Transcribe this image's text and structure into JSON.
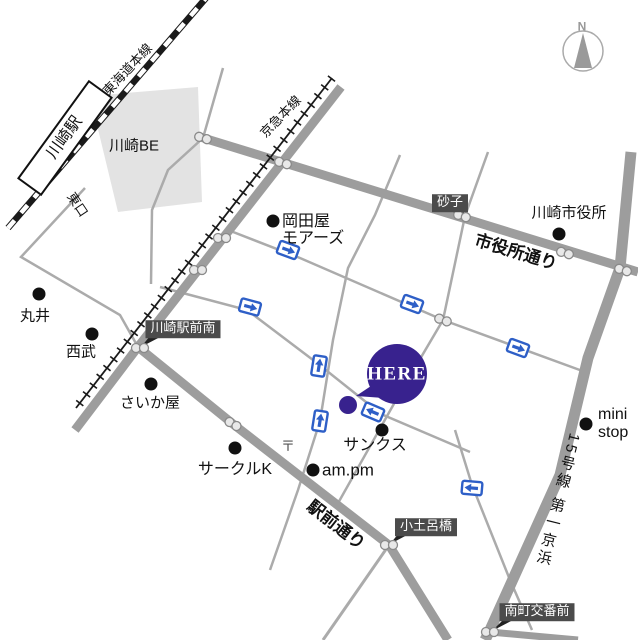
{
  "map_title": "Kawasaki station area access map",
  "colors": {
    "background": "#ffffff",
    "road": "#9d9d9d",
    "thin_road": "#ababab",
    "rail": "#1a1a1a",
    "building": "#e3e3e3",
    "here_purple": "#38228e",
    "oneway_blue": "#2e5fc7",
    "signal_fill": "#e8e8e8",
    "signal_stroke": "#8a8a8a",
    "dark_label_bg": "#4b4b4b",
    "poi_dot": "#111111",
    "compass_gray": "#9a9a9a"
  },
  "labels": {
    "station": {
      "text": "川崎駅",
      "x": 65,
      "y": 138,
      "rot": -54,
      "size": 16
    },
    "jr_line": {
      "text": "東海道本線",
      "x": 128,
      "y": 70,
      "rot": -47,
      "size": 13
    },
    "keikyu_line": {
      "text": "京急本線",
      "x": 281,
      "y": 117,
      "rot": -46,
      "size": 13
    },
    "kawasaki_be": {
      "text": "川崎BE",
      "x": 134,
      "y": 147,
      "size": 15
    },
    "higashi_guchi": {
      "text": "東口",
      "x": 77,
      "y": 205,
      "rot": 56,
      "size": 13
    },
    "okadaya_1": {
      "text": "岡田屋",
      "x": 282,
      "y": 222,
      "size": 16,
      "align": "left"
    },
    "okadaya_2": {
      "text": "モアーズ",
      "x": 282,
      "y": 239,
      "size": 16,
      "align": "left"
    },
    "sunako": {
      "text": "砂子",
      "x": 450,
      "y": 203,
      "size": 13
    },
    "shiyakusho_dori": {
      "text": "市役所通り",
      "x": 516,
      "y": 252,
      "rot": 17,
      "size": 17,
      "bold": true,
      "halo": true
    },
    "city_hall": {
      "text": "川崎市役所",
      "x": 569,
      "y": 214,
      "size": 15
    },
    "marui": {
      "text": "丸井",
      "x": 35,
      "y": 317,
      "size": 15
    },
    "seibu": {
      "text": "西武",
      "x": 81,
      "y": 353,
      "size": 15
    },
    "ekimae_minami": {
      "text": "川崎駅前南",
      "x": 183,
      "y": 329,
      "size": 13
    },
    "saikaya": {
      "text": "さいか屋",
      "x": 150,
      "y": 404,
      "size": 15
    },
    "sunkus": {
      "text": "サンクス",
      "x": 375,
      "y": 446,
      "size": 16
    },
    "circle_k": {
      "text": "サークルK",
      "x": 235,
      "y": 470,
      "size": 16
    },
    "am_pm": {
      "text": "am.pm",
      "x": 322,
      "y": 470,
      "size": 17,
      "align": "left"
    },
    "post_mark": {
      "text": "〒",
      "x": 288,
      "y": 447,
      "size": 14,
      "color": "#555555"
    },
    "mini_stop_1": {
      "text": "mini",
      "x": 598,
      "y": 415,
      "size": 16,
      "align": "left"
    },
    "mini_stop_2": {
      "text": "stop",
      "x": 598,
      "y": 433,
      "size": 16,
      "align": "left"
    },
    "ekimae_dori": {
      "text": "駅前通り",
      "x": 336,
      "y": 525,
      "rot": 38,
      "size": 17,
      "bold": true,
      "halo": true
    },
    "kodorobashi": {
      "text": "小土呂橋",
      "x": 426,
      "y": 527,
      "size": 13
    },
    "route15": {
      "text": "15号線 第一京浜",
      "x": 557,
      "y": 500,
      "rot": 14,
      "size": 15,
      "vertical": true
    },
    "minamicho": {
      "text": "南町交番前",
      "x": 537,
      "y": 612,
      "size": 13
    },
    "here": {
      "text": "HERE",
      "x": 397,
      "y": 374,
      "size": 19,
      "bold": true,
      "ls": 1.5
    },
    "compass_n": {
      "text": "N",
      "x": 582,
      "y": 27,
      "size": 12,
      "bold": true,
      "color": "#999999"
    }
  },
  "geometry": {
    "railways": {
      "jr": {
        "points": [
          [
            8,
            228
          ],
          [
            206,
            -2
          ]
        ]
      },
      "keikyu": {
        "points": [
          [
            332,
            78
          ],
          [
            76,
            408
          ]
        ]
      }
    },
    "station_box": {
      "cx": 65,
      "cy": 138,
      "w": 120,
      "h": 28,
      "rot": -54
    },
    "building": [
      [
        90,
        96
      ],
      [
        198,
        87
      ],
      [
        202,
        202
      ],
      [
        118,
        212
      ]
    ],
    "roads": [
      {
        "name": "okadaya-street",
        "points": [
          [
            228,
            230
          ],
          [
            300,
            258
          ],
          [
            443,
            320
          ],
          [
            588,
            373
          ]
        ],
        "w": 2.5,
        "thin": true
      },
      {
        "name": "here-street",
        "points": [
          [
            160,
            287
          ],
          [
            247,
            310
          ],
          [
            317,
            363
          ],
          [
            381,
            414
          ],
          [
            470,
            452
          ]
        ],
        "w": 2.5,
        "thin": true
      },
      {
        "name": "sunako-street",
        "points": [
          [
            488,
            152
          ],
          [
            465,
            216
          ],
          [
            443,
            320
          ],
          [
            400,
            393
          ],
          [
            337,
            505
          ]
        ],
        "w": 2.5,
        "thin": true
      },
      {
        "name": "center-street",
        "points": [
          [
            400,
            155
          ],
          [
            375,
            215
          ],
          [
            348,
            268
          ],
          [
            333,
            340
          ],
          [
            320,
            421
          ],
          [
            298,
            490
          ],
          [
            270,
            570
          ]
        ],
        "w": 2.5,
        "thin": true
      },
      {
        "name": "south-street",
        "points": [
          [
            455,
            430
          ],
          [
            472,
            485
          ],
          [
            510,
            580
          ],
          [
            532,
            630
          ]
        ],
        "w": 2.5,
        "thin": true
      },
      {
        "name": "be-street",
        "points": [
          [
            223,
            68
          ],
          [
            203,
            138
          ],
          [
            168,
            170
          ],
          [
            152,
            210
          ],
          [
            151,
            284
          ]
        ],
        "w": 2.5,
        "thin": true
      },
      {
        "name": "east-exit-street",
        "points": [
          [
            85,
            188
          ],
          [
            21,
            257
          ],
          [
            120,
            315
          ],
          [
            138,
            347
          ]
        ],
        "w": 2.5,
        "thin": true
      },
      {
        "name": "ekimae-branch-road",
        "points": [
          [
            389,
            545
          ],
          [
            323,
            640
          ]
        ],
        "w": 3,
        "thin": true
      },
      {
        "name": "shiyakusho-dori-road",
        "points": [
          [
            197,
            136
          ],
          [
            638,
            272
          ]
        ],
        "w": 9
      },
      {
        "name": "station-road",
        "points": [
          [
            341,
            87
          ],
          [
            138,
            347
          ],
          [
            75,
            430
          ]
        ],
        "w": 9
      },
      {
        "name": "ekimae-dori-road",
        "points": [
          [
            138,
            347
          ],
          [
            233,
            424
          ],
          [
            389,
            545
          ],
          [
            448,
            640
          ]
        ],
        "w": 9
      },
      {
        "name": "minamicho-road",
        "points": [
          [
            490,
            632
          ],
          [
            578,
            640
          ]
        ],
        "w": 7
      },
      {
        "name": "route15-road",
        "points": [
          [
            631,
            152
          ],
          [
            620,
            268
          ],
          [
            588,
            358
          ],
          [
            560,
            475
          ],
          [
            490,
            630
          ],
          [
            485,
            640
          ]
        ],
        "w": 11
      }
    ],
    "signals": [
      [
        203,
        138,
        17
      ],
      [
        283,
        163,
        17
      ],
      [
        462,
        216,
        17
      ],
      [
        565,
        253,
        17
      ],
      [
        623,
        270,
        17
      ],
      [
        222,
        238,
        0
      ],
      [
        198,
        270,
        0
      ],
      [
        140,
        348,
        0
      ],
      [
        233,
        424,
        30
      ],
      [
        443,
        320,
        20
      ],
      [
        389,
        545,
        0
      ],
      [
        490,
        632,
        0
      ]
    ],
    "oneway_icons": [
      [
        288,
        250,
        20
      ],
      [
        412,
        304,
        20
      ],
      [
        518,
        348,
        20
      ],
      [
        250,
        307,
        15
      ],
      [
        373,
        412,
        203
      ],
      [
        319,
        366,
        -81
      ],
      [
        320,
        421,
        -81
      ],
      [
        472,
        488,
        185
      ]
    ],
    "poi_dots": [
      [
        273,
        221
      ],
      [
        559,
        234
      ],
      [
        39,
        294
      ],
      [
        92,
        334
      ],
      [
        151,
        384
      ],
      [
        382,
        430
      ],
      [
        235,
        448
      ],
      [
        313,
        470
      ],
      [
        586,
        424
      ]
    ],
    "here": {
      "cx": 397,
      "cy": 374,
      "r": 30,
      "tail": [
        [
          371,
          386
        ],
        [
          383,
          398
        ],
        [
          356,
          396
        ]
      ],
      "dot": [
        348,
        405,
        9
      ]
    },
    "compass": {
      "cx": 583,
      "cy": 51,
      "r": 20,
      "needle": [
        [
          583,
          33
        ],
        [
          574,
          68
        ],
        [
          592,
          68
        ]
      ]
    },
    "pointers": [
      [
        [
          452,
          211
        ],
        [
          464,
          211
        ],
        [
          463,
          220
        ]
      ],
      [
        [
          150,
          336
        ],
        [
          162,
          336
        ],
        [
          141,
          347
        ]
      ],
      [
        [
          399,
          533
        ],
        [
          411,
          533
        ],
        [
          390,
          544
        ]
      ],
      [
        [
          505,
          618
        ],
        [
          517,
          618
        ],
        [
          492,
          631
        ]
      ]
    ]
  }
}
